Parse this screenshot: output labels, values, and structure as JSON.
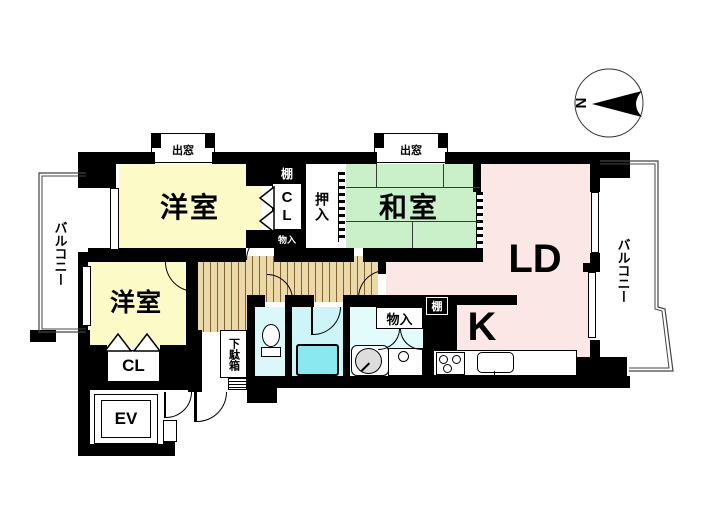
{
  "title": "マンション間取り図",
  "labels": {
    "yoshitsu1": "洋室",
    "yoshitsu2": "洋室",
    "washitsu": "和室",
    "ld": "LD",
    "kitchen": "K",
    "cl_top": "CL",
    "cl_bottom": "CL",
    "ev": "EV",
    "oshiire": "押入",
    "tana_top": "棚",
    "tana_kitchen": "棚",
    "monoire_top": "物入",
    "monoire_wash": "物入",
    "demado_left": "出窓",
    "demado_right": "出窓",
    "getabako": "下駄箱",
    "balcony_left": "バルコニー",
    "balcony_right": "バルコニー",
    "compass_north": "N"
  },
  "colors": {
    "wall": "#000000",
    "western_room": "#fcfac6",
    "japanese_room": "#c9f0c9",
    "living_dining": "#fbe7e5",
    "hall_wood": "#ecd9a9",
    "bathroom": "#cdf4f6",
    "bathtub": "#8ae8f1",
    "washroom": "#e2fbfb",
    "toilet": "#daf7f9"
  }
}
